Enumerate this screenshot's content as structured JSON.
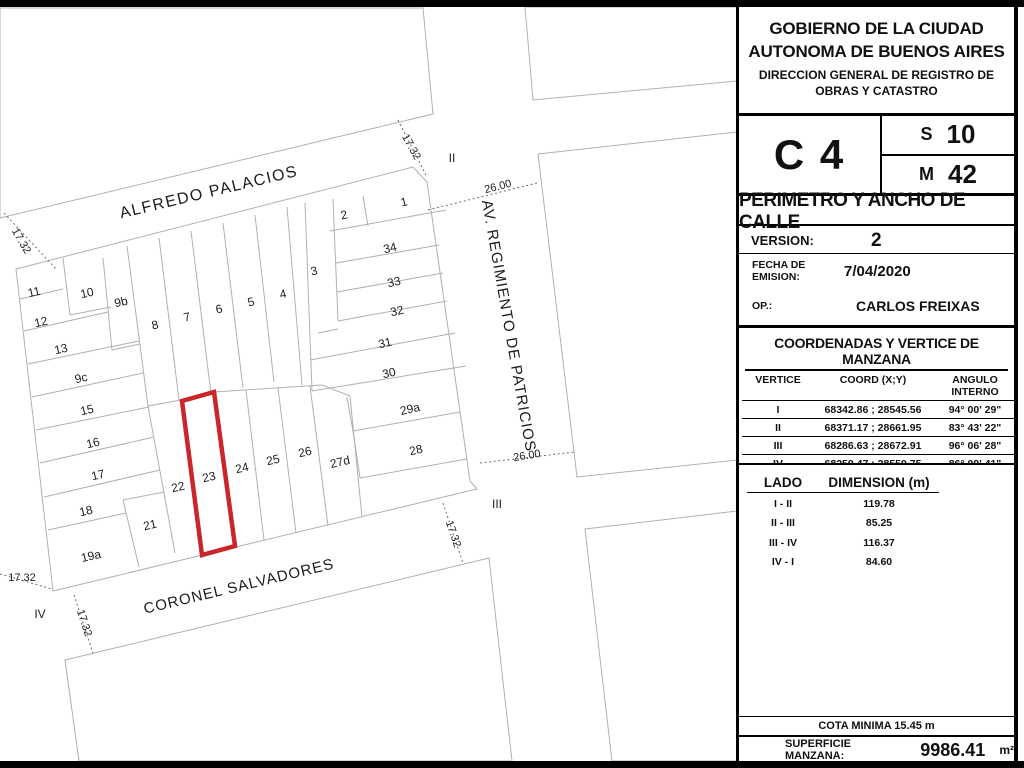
{
  "sidebar": {
    "org_line1": "GOBIERNO DE LA CIUDAD",
    "org_line2": "AUTONOMA DE BUENOS AIRES",
    "dept_line1": "DIRECCION GENERAL DE REGISTRO DE",
    "dept_line2": "OBRAS Y CATASTRO",
    "circunscripcion": "C 4",
    "seccion_label": "S",
    "seccion": "10",
    "manzana_label": "M",
    "manzana": "42",
    "sheet_title": "PERIMETRO Y ANCHO DE CALLE",
    "version_label": "VERSION:",
    "version": "2",
    "fecha_label": "FECHA DE EMISION:",
    "fecha": "7/04/2020",
    "op_label": "OP.:",
    "op": "CARLOS FREIXAS",
    "coords": {
      "title": "COORDENADAS Y VERTICE DE MANZANA",
      "headers": [
        "VERTICE",
        "COORD (X;Y)",
        "ANGULO INTERNO"
      ],
      "rows": [
        {
          "vertice": "I",
          "coord": "68342.86 ; 28545.56",
          "angulo": "94° 00' 29\""
        },
        {
          "vertice": "II",
          "coord": "68371.17 ; 28661.95",
          "angulo": "83° 43' 22\""
        },
        {
          "vertice": "III",
          "coord": "68286.63 ; 28672.91",
          "angulo": "96° 06' 28\""
        },
        {
          "vertice": "IV",
          "coord": "68259.47 ; 28559.75",
          "angulo": "86° 09' 41\""
        }
      ]
    },
    "lados": {
      "headers": [
        "LADO",
        "DIMENSION (m)"
      ],
      "rows": [
        {
          "lado": "I - II",
          "dim": "119.78"
        },
        {
          "lado": "II - III",
          "dim": "85.25"
        },
        {
          "lado": "III - IV",
          "dim": "116.37"
        },
        {
          "lado": "IV - I",
          "dim": "84.60"
        }
      ]
    },
    "cota": "COTA MINIMA 15.45 m",
    "superficie_label": "SUPERFICIE MANZANA:",
    "superficie": "9986.41",
    "superficie_unit": "m²"
  },
  "map": {
    "streets": {
      "top": "ALFREDO PALACIOS",
      "bottom": "CORONEL SALVADORES",
      "right": "AV. REGIMIENTO DE PATRICIOS"
    },
    "dims": {
      "w1732": "17.32",
      "w2600": "26.00"
    },
    "vertices": [
      "II",
      "III",
      "IV"
    ],
    "highlight": {
      "parcel": "23",
      "color": "#c9252b"
    },
    "parcels": [
      "11",
      "12",
      "13",
      "9c",
      "15",
      "16",
      "17",
      "18",
      "19a",
      "10",
      "9b",
      "8",
      "7",
      "6",
      "5",
      "4",
      "3",
      "2",
      "1",
      "34",
      "33",
      "32",
      "31",
      "30",
      "29a",
      "28",
      "27d",
      "26",
      "25",
      "24",
      "23",
      "22",
      "21"
    ]
  }
}
